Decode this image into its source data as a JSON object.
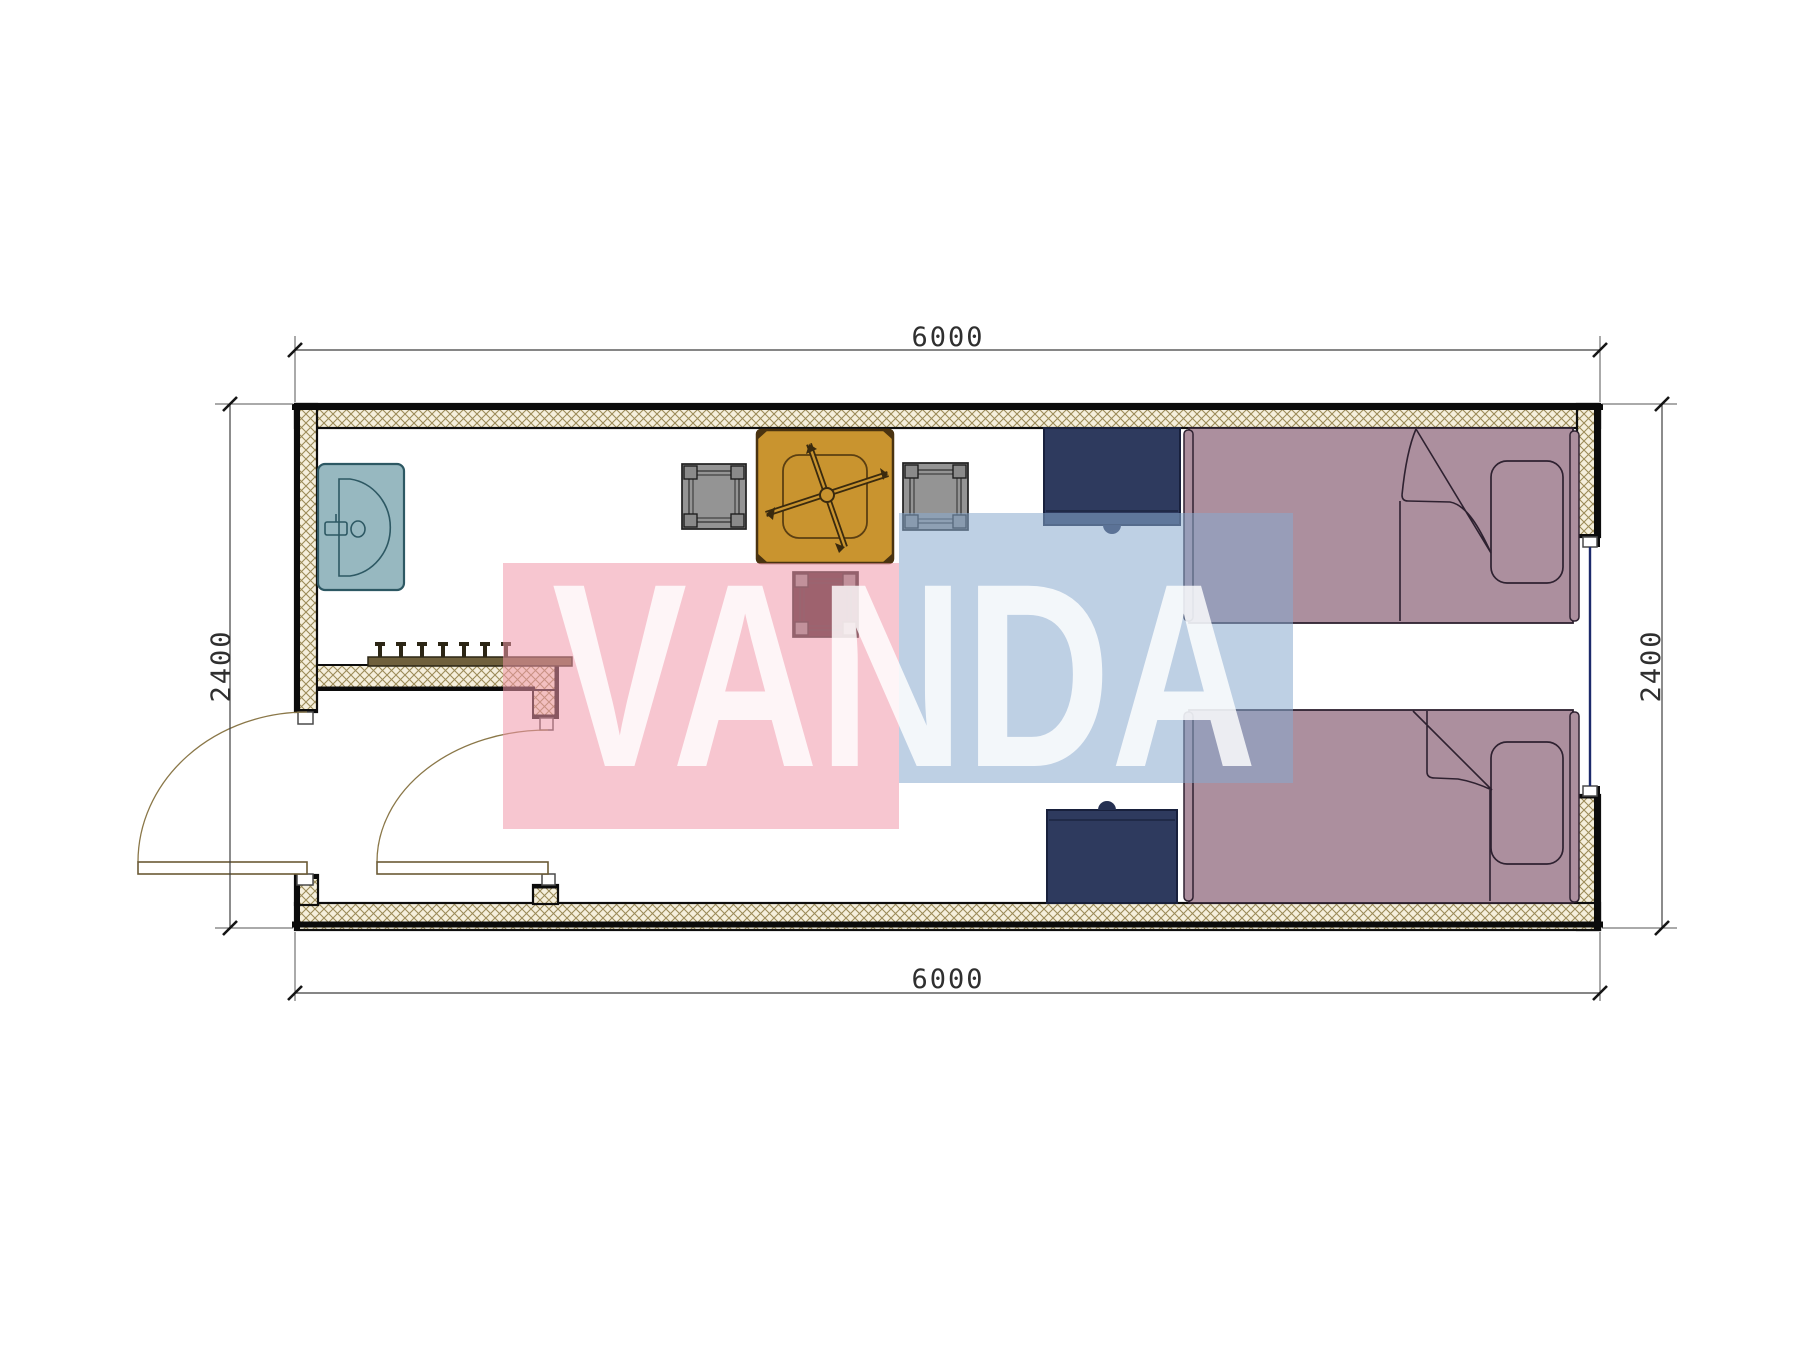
{
  "drawing": {
    "type": "floor-plan",
    "description": "container room plan with entry vestibule, washbasin, table with stools, two single beds and two nightstands",
    "dimensions": {
      "top": "6000",
      "bottom": "6000",
      "left": "2400",
      "right": "2400"
    },
    "watermark": {
      "text": "VANDA",
      "pink": "rgba(240,151,170,0.55)",
      "blue": "rgba(137,170,206,0.55)",
      "text_color": "rgba(255,255,255,0.82)"
    },
    "colors": {
      "wall_hatch_bg": "#f5efdc",
      "wall_hatch_line": "#9b8b58",
      "wall_line": "#0d0d0d",
      "dim_line": "#3f3f3f",
      "dim_text": "#2f2f2f",
      "door_arc": "#8a7748",
      "door_leaf_fill": "#ffffff",
      "window_line": "#1c2a6b",
      "jamb_fill": "#ffffff"
    },
    "furniture": {
      "sink": {
        "label": "washbasin",
        "fill": "#97b8c0",
        "stroke": "#2d5863"
      },
      "coat_rack": {
        "label": "coat rack with hooks",
        "fill": "#6f603c",
        "hook": "#2c2615"
      },
      "table": {
        "label": "square table with fan symbol",
        "fill": "#c9942f",
        "stroke": "#4a3310"
      },
      "stool": {
        "label": "stool",
        "fill": "#949494",
        "stroke": "#1f1f1f",
        "leg": "#8a8a8a",
        "dark_seat": "#3a2227"
      },
      "bed": {
        "label": "single bed",
        "fill": "#ac8f9e",
        "stroke": "#2e2130"
      },
      "nightstand": {
        "label": "nightstand",
        "fill": "#2e3a5e",
        "stroke": "#18203c",
        "knob": "#253052"
      }
    }
  }
}
